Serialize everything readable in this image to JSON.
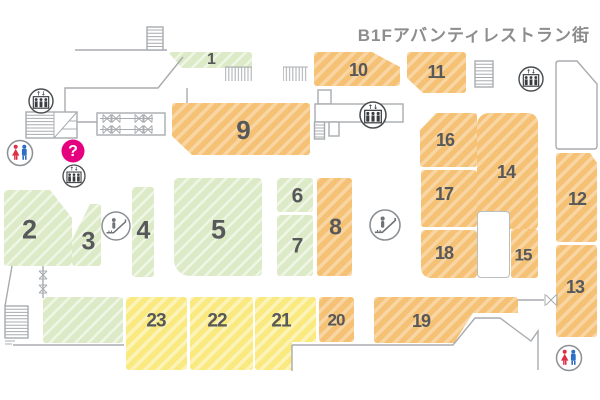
{
  "title": "B1Fアバンティレストラン街",
  "colors": {
    "green_block": "#dceac7",
    "orange_block": "#f5c174",
    "yellow_block": "#fae97e",
    "number_text": "#57585a",
    "wall_line": "#a8acaf",
    "info_pink": "#e4007f",
    "title_text": "#8d8d8d",
    "female_red": "#dd2f46",
    "male_blue": "#2e6fc5"
  },
  "map": {
    "blocks": [
      {
        "name": "shop-block-1",
        "label": "1",
        "type": "green",
        "x": 168,
        "y": 52,
        "w": 84,
        "h": 16,
        "clip": "polygon(0px 0px,84px 0px,84px 16px,14px 16px)",
        "lx": 211,
        "ly": 60,
        "fs": 16
      },
      {
        "name": "shop-block-2",
        "label": "2",
        "type": "green",
        "x": 4,
        "y": 190,
        "w": 68,
        "h": 76,
        "clip": "polygon(0px 0px,46px 0px,68px 28px,68px 76px,0px 76px)",
        "lx": 29,
        "ly": 230,
        "fs": 27
      },
      {
        "name": "shop-block-3",
        "label": "3",
        "type": "green",
        "x": 72,
        "y": 204,
        "w": 29,
        "h": 62,
        "clip": "polygon(18px 0px,29px 0px,29px 62px,0px 62px,0px 36px)",
        "lx": 88,
        "ly": 242,
        "fs": 25
      },
      {
        "name": "shop-block-4",
        "label": "4",
        "type": "green",
        "x": 132,
        "y": 187,
        "w": 22,
        "h": 90,
        "lx": 143,
        "ly": 231,
        "fs": 25
      },
      {
        "name": "shop-block-5",
        "label": "5",
        "type": "green",
        "x": 174,
        "y": 178,
        "w": 88,
        "h": 98,
        "radius": "4px 4px 4px 16px",
        "lx": 218,
        "ly": 230,
        "fs": 27
      },
      {
        "name": "shop-block-6",
        "label": "6",
        "type": "green",
        "x": 277,
        "y": 178,
        "w": 36,
        "h": 34,
        "lx": 297,
        "ly": 196,
        "fs": 21
      },
      {
        "name": "shop-block-7",
        "label": "7",
        "type": "green",
        "x": 277,
        "y": 215,
        "w": 36,
        "h": 61,
        "lx": 297,
        "ly": 246,
        "fs": 21
      },
      {
        "name": "shop-block-8",
        "label": "8",
        "type": "orange",
        "x": 317,
        "y": 178,
        "w": 35,
        "h": 98,
        "lx": 335,
        "ly": 227,
        "fs": 23
      },
      {
        "name": "shop-block-9",
        "label": "9",
        "type": "orange",
        "x": 172,
        "y": 103,
        "w": 138,
        "h": 52,
        "clip": "polygon(0px 0px,138px 0px,138px 52px,20px 52px,0px 33px)",
        "lx": 243,
        "ly": 130,
        "fs": 26
      },
      {
        "name": "shop-block-10",
        "label": "10",
        "type": "orange",
        "x": 314,
        "y": 52,
        "w": 86,
        "h": 34,
        "clip": "polygon(0px 0px,58px 0px,86px 15px,86px 34px,0px 34px)",
        "lx": 358,
        "ly": 70,
        "fs": 18
      },
      {
        "name": "shop-block-11",
        "label": "11",
        "type": "orange",
        "x": 407,
        "y": 52,
        "w": 59,
        "h": 41,
        "clip": "polygon(0px 0px,59px 0px,59px 41px,16px 41px,0px 26px)",
        "lx": 436,
        "ly": 72,
        "fs": 18
      },
      {
        "name": "shop-block-12",
        "label": "12",
        "type": "orange",
        "x": 556,
        "y": 153,
        "w": 41,
        "h": 89,
        "clip": "polygon(0px 0px,34px 0px,41px 10px,41px 89px,0px 89px)",
        "lx": 577,
        "ly": 199,
        "fs": 18
      },
      {
        "name": "shop-block-13",
        "label": "13",
        "type": "orange",
        "x": 556,
        "y": 245,
        "w": 41,
        "h": 92,
        "lx": 575,
        "ly": 287,
        "fs": 18
      },
      {
        "name": "shop-block-14",
        "label": "14",
        "type": "orange",
        "x": 477,
        "y": 113,
        "w": 61,
        "h": 116,
        "radius": "12px 10px 4px 4px",
        "lx": 506,
        "ly": 172,
        "fs": 18
      },
      {
        "name": "corridor-cutout",
        "label": "",
        "type": "cutout",
        "x": 477,
        "y": 211,
        "w": 33,
        "h": 67
      },
      {
        "name": "shop-block-15",
        "label": "15",
        "type": "orange",
        "x": 511,
        "y": 229,
        "w": 27,
        "h": 49,
        "lx": 523,
        "ly": 255,
        "fs": 17
      },
      {
        "name": "shop-block-16",
        "label": "16",
        "type": "orange",
        "x": 420,
        "y": 113,
        "w": 57,
        "h": 54,
        "clip": "polygon(16px 0px,57px 0px,57px 54px,0px 54px,0px 17px)",
        "lx": 445,
        "ly": 140,
        "fs": 18
      },
      {
        "name": "shop-block-17",
        "label": "17",
        "type": "orange",
        "x": 421,
        "y": 170,
        "w": 56,
        "h": 57,
        "lx": 444,
        "ly": 194,
        "fs": 18
      },
      {
        "name": "shop-block-18",
        "label": "18",
        "type": "orange",
        "x": 421,
        "y": 230,
        "w": 56,
        "h": 48,
        "radius": "4px 4px 4px 10px",
        "lx": 444,
        "ly": 253,
        "fs": 18
      },
      {
        "name": "shop-block-19",
        "label": "19",
        "type": "orange",
        "x": 374,
        "y": 297,
        "w": 144,
        "h": 46,
        "clip": "polygon(0px 0px,144px 0px,144px 16px,99px 16px,80px 46px,0px 46px)",
        "lx": 421,
        "ly": 321,
        "fs": 18
      },
      {
        "name": "shop-block-20",
        "label": "20",
        "type": "orange",
        "x": 319,
        "y": 297,
        "w": 35,
        "h": 45,
        "lx": 336,
        "ly": 320,
        "fs": 17
      },
      {
        "name": "shop-block-21",
        "label": "21",
        "type": "yellow",
        "x": 255,
        "y": 297,
        "w": 61,
        "h": 73,
        "clip": "polygon(0px 0px,61px 0px,61px 45px,37px 45px,37px 73px,0px 73px)",
        "lx": 281,
        "ly": 321,
        "fs": 19
      },
      {
        "name": "shop-block-22",
        "label": "22",
        "type": "yellow",
        "x": 190,
        "y": 297,
        "w": 63,
        "h": 73,
        "lx": 217,
        "ly": 321,
        "fs": 19
      },
      {
        "name": "shop-block-23",
        "label": "23",
        "type": "yellow",
        "x": 126,
        "y": 297,
        "w": 61,
        "h": 73,
        "lx": 156,
        "ly": 321,
        "fs": 19
      },
      {
        "name": "service-room",
        "label": "",
        "type": "green",
        "x": 43,
        "y": 297,
        "w": 80,
        "h": 46
      }
    ],
    "icons": [
      {
        "name": "elevator-icon-upper-left",
        "type": "elevator",
        "x": 41,
        "y": 101,
        "r": 12
      },
      {
        "name": "elevator-icon-center-left",
        "type": "elevator",
        "x": 74,
        "y": 176,
        "r": 11
      },
      {
        "name": "elevator-icon-central",
        "type": "elevator",
        "x": 373,
        "y": 115,
        "r": 13
      },
      {
        "name": "elevator-icon-upper-right",
        "type": "elevator",
        "x": 531,
        "y": 79,
        "r": 12
      },
      {
        "name": "restroom-icon-left",
        "type": "restroom",
        "x": 20,
        "y": 153,
        "r": 12.5
      },
      {
        "name": "restroom-icon-lower-right",
        "type": "restroom",
        "x": 569,
        "y": 358,
        "r": 12.5
      },
      {
        "name": "information-icon",
        "type": "question",
        "x": 73,
        "y": 151,
        "r": 11.5
      },
      {
        "name": "escalator-icon-left",
        "type": "escalator",
        "x": 116,
        "y": 226,
        "r": 14
      },
      {
        "name": "escalator-icon-right",
        "type": "escalator",
        "x": 385,
        "y": 225,
        "r": 15
      }
    ]
  }
}
